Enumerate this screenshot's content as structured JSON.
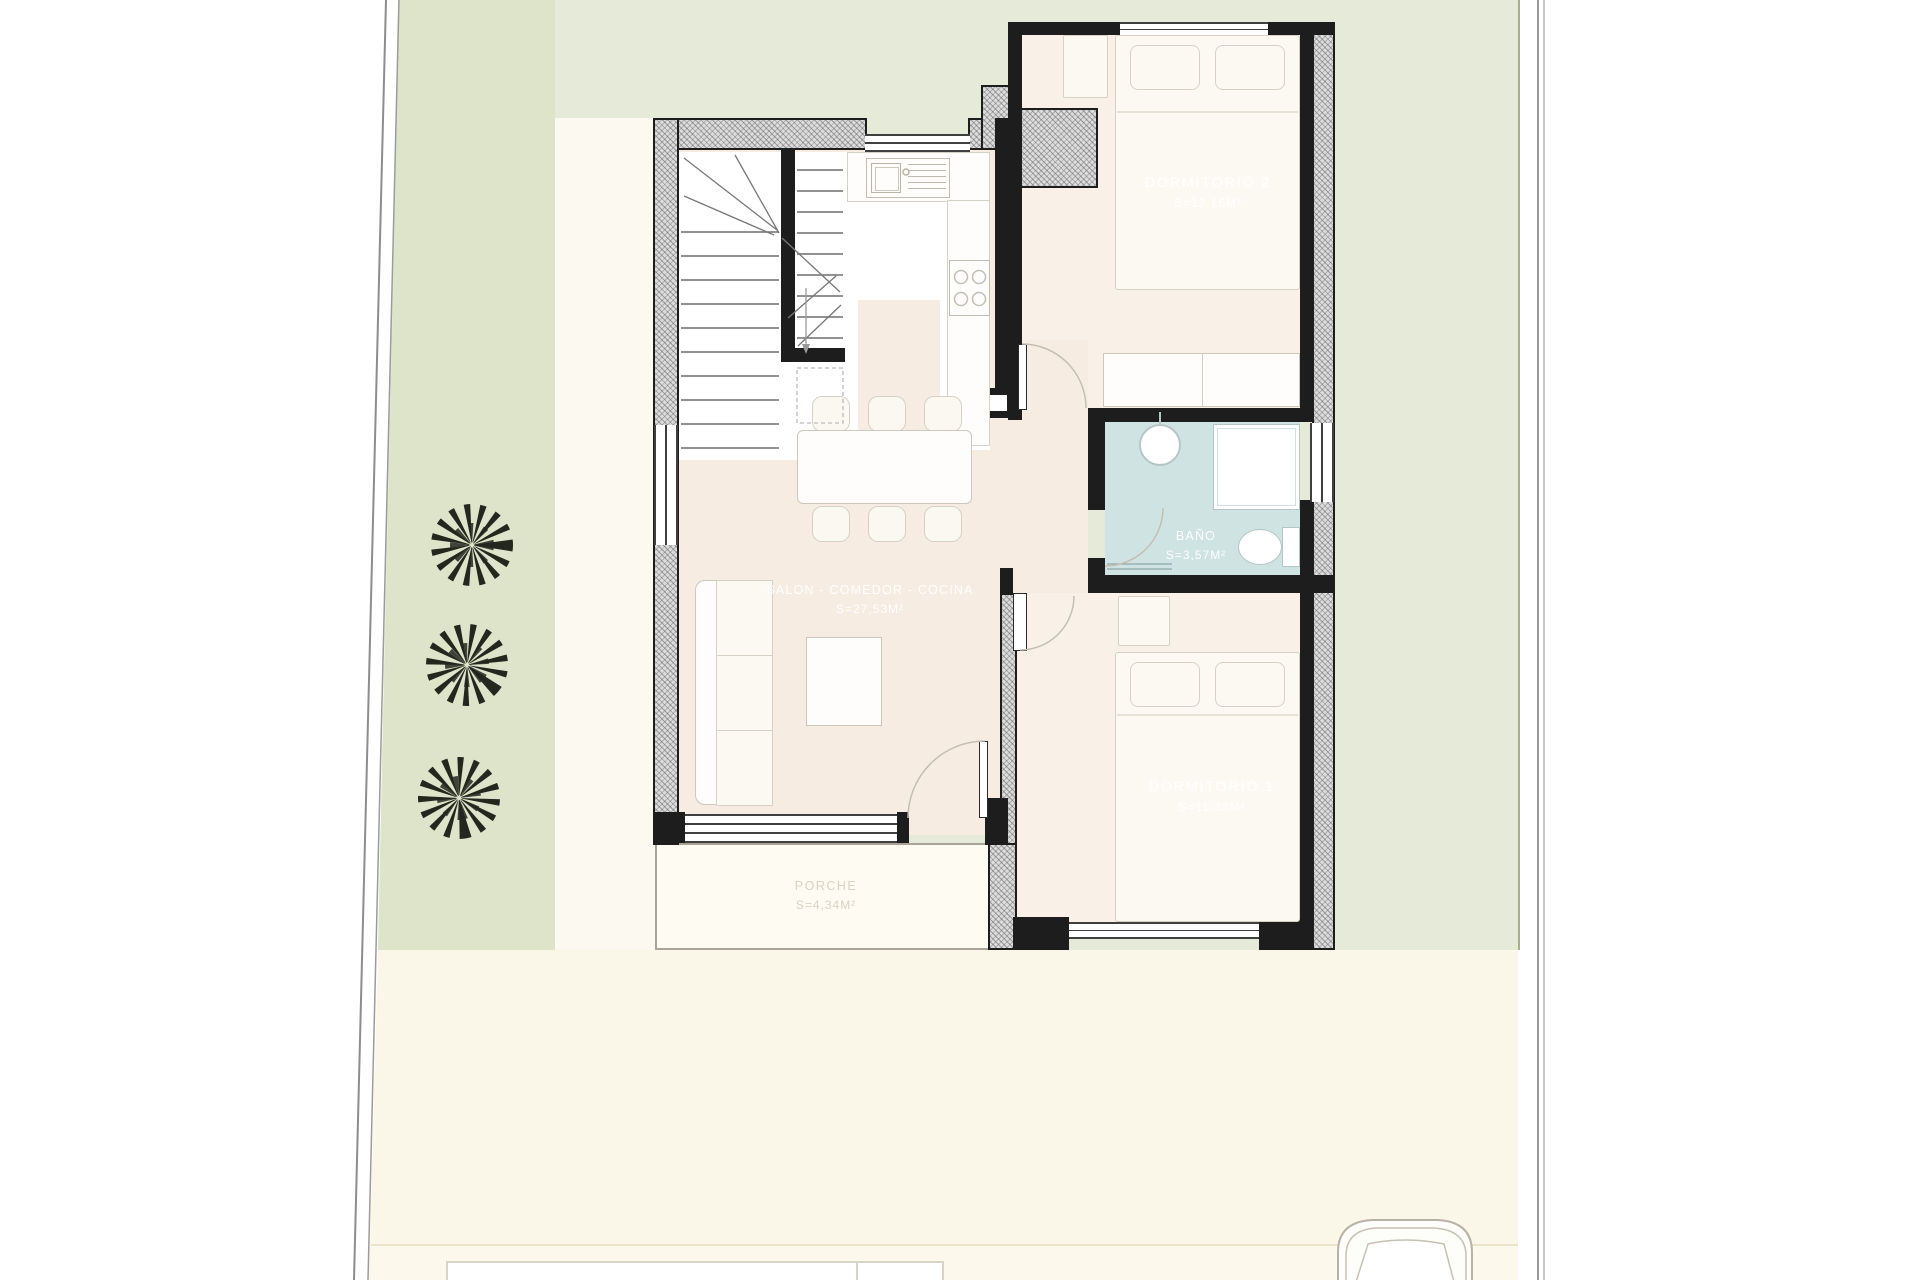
{
  "plan": {
    "title": "single-storey villa floor plan",
    "rooms": [
      {
        "id": "salon",
        "name": "SALON - COMEDOR - COCINA",
        "area": "S=27,53m²"
      },
      {
        "id": "dormitorio2",
        "name": "DORMITORIO  2",
        "area": "S=12,16m²"
      },
      {
        "id": "bano",
        "name": "BAÑO",
        "area": "S=3,57m²"
      },
      {
        "id": "dormitorio1",
        "name": "DORMITORIO  1",
        "area": "S=11,33m²"
      },
      {
        "id": "porche",
        "name": "PORCHE",
        "area": "S=4,34m²"
      }
    ],
    "colors": {
      "site_green": "#e6ead8",
      "garden_strip": "#dde4ca",
      "ground_cream": "#faf7e8",
      "floor_living": "#f7ece1",
      "floor_bedroom": "#f9f0e8",
      "bath_blue": "#cfe3e2",
      "wall": "#1d1d1d",
      "porch_fill": "#fdfbf2"
    }
  }
}
